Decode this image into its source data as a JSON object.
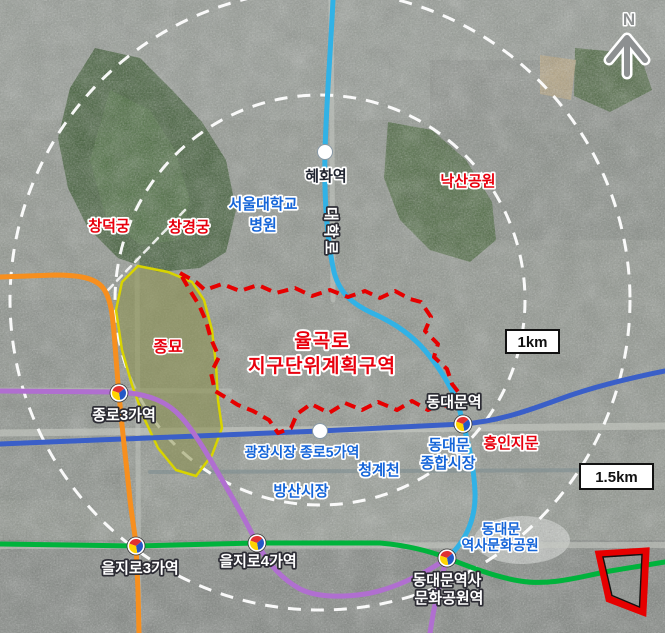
{
  "map": {
    "description": "satellite-district-plan-map",
    "labels": {
      "hyehwa_station": "혜화역",
      "snu_hospital_line1": "서울대학교",
      "snu_hospital_line2": "병원",
      "daehangno_road": "대학로",
      "naksan_park": "낙산공원",
      "changdeokgung": "창덕궁",
      "changgyeonggung": "창경궁",
      "jongmyo": "종묘",
      "plan_area_line1": "율곡로",
      "plan_area_line2": "지구단위계획구역",
      "ring_1km": "1km",
      "ring_1_5km": "1.5km",
      "dongdaemun_station": "동대문역",
      "jongno3ga_station": "종로3가역",
      "heunginjimun": "흥인지문",
      "gwangjang_jongno5ga_station": "광장시장 종로5가역",
      "cheonggyecheon": "청계천",
      "dongdaemun_market_line1": "동대문",
      "dongdaemun_market_line2": "종합시장",
      "bangsan_market": "방산시장",
      "ddp_park_line1": "동대문",
      "ddp_park_line2": "역사문화공원",
      "euljiro3ga_station": "을지로3가역",
      "euljiro4ga_station": "을지로4가역",
      "ddp_station_line1": "동대문역사",
      "ddp_station_line2": "문화공원역",
      "compass_north": "N"
    },
    "colors": {
      "subway_line1_blue": "#3a5fc8",
      "subway_line2_green": "#00b33c",
      "subway_line3_orange": "#f78f1e",
      "subway_line4_cyan": "#31b2e6",
      "subway_line5_purple": "#b06fd0",
      "plan_boundary_red": "#e60000",
      "jongmyo_boundary_yellow": "#d8d400",
      "radius_ring_white": "#ffffff",
      "place_label_red": "#e8000d",
      "place_label_blue": "#1565d8",
      "highlight_frame_red": "#e60000"
    },
    "scale_rings": [
      {
        "label": "1km"
      },
      {
        "label": "1.5km"
      }
    ]
  }
}
